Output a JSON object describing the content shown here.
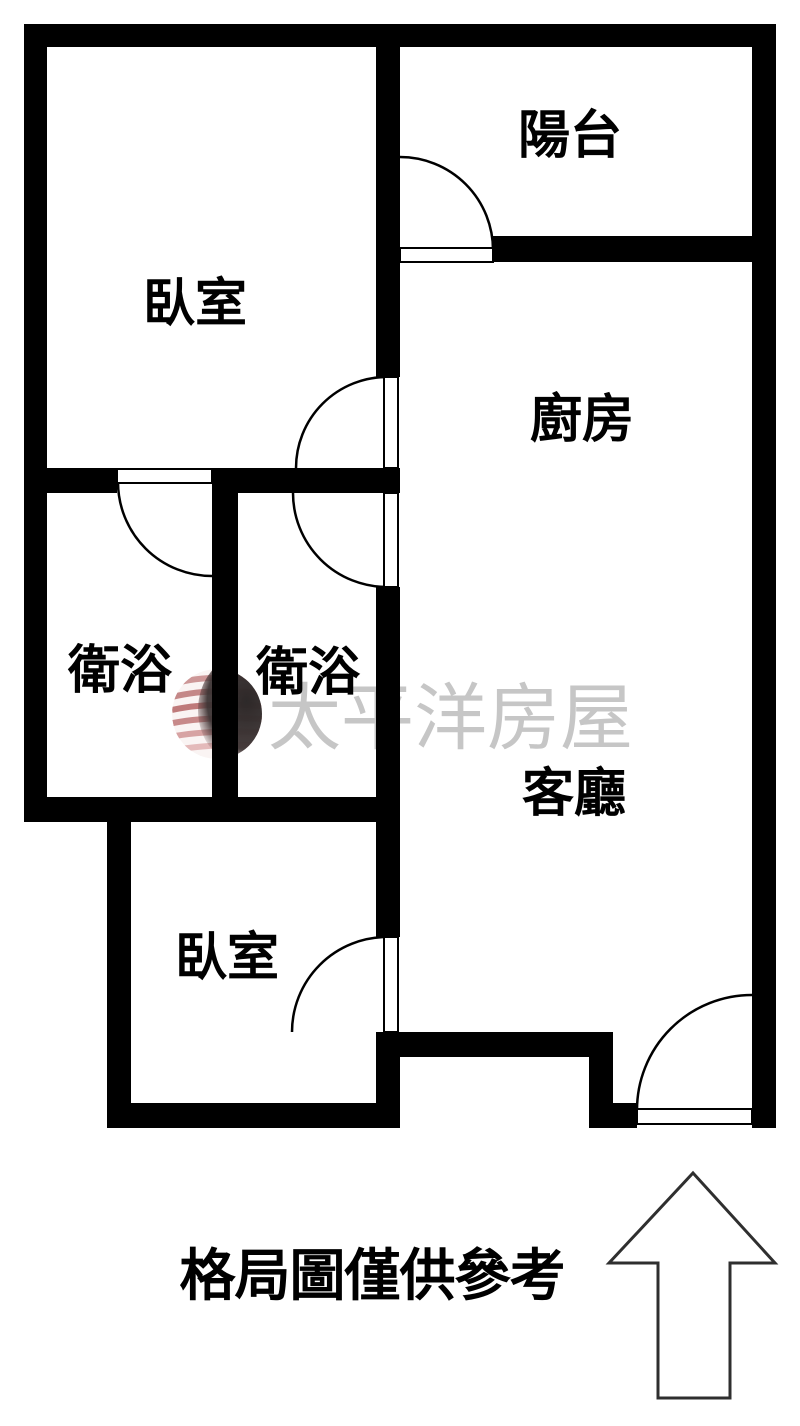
{
  "floor_plan": {
    "type": "apartment-floor-plan",
    "rooms": [
      {
        "id": "bedroom-top",
        "label": "臥室"
      },
      {
        "id": "balcony",
        "label": "陽台"
      },
      {
        "id": "kitchen",
        "label": "廚房"
      },
      {
        "id": "bathroom-left",
        "label": "衛浴"
      },
      {
        "id": "bathroom-right",
        "label": "衛浴"
      },
      {
        "id": "living-room",
        "label": "客廳"
      },
      {
        "id": "bedroom-bottom",
        "label": "臥室"
      }
    ],
    "doors": [
      {
        "id": "balcony-door",
        "between": "bedroom-top / balcony wall opening"
      },
      {
        "id": "bedroom-top-door",
        "between": "bedroom-top / kitchen"
      },
      {
        "id": "bathroom-left-door",
        "between": "bedroom-top / bathroom-left"
      },
      {
        "id": "bathroom-right-door",
        "between": "living area / bathroom-right"
      },
      {
        "id": "bedroom-bottom-door",
        "between": "living-room / bedroom-bottom"
      },
      {
        "id": "entrance-door",
        "between": "exterior / living-room"
      }
    ],
    "caption": "格局圖僅供參考",
    "watermark": {
      "brand": "太平洋房屋",
      "logo": "pacific-globe-logo"
    },
    "compass": {
      "type": "north-arrow",
      "direction": "up"
    },
    "colors": {
      "background": "#ffffff",
      "wall": "#000000",
      "door_line": "#000000",
      "label_text": "#000000",
      "watermark_text": "#c6c6c6",
      "logo_red_light": "#e2b5b5",
      "logo_red": "#b05050",
      "logo_dark": "#221d1d",
      "arrow_outline": "#2f2f2f"
    }
  }
}
